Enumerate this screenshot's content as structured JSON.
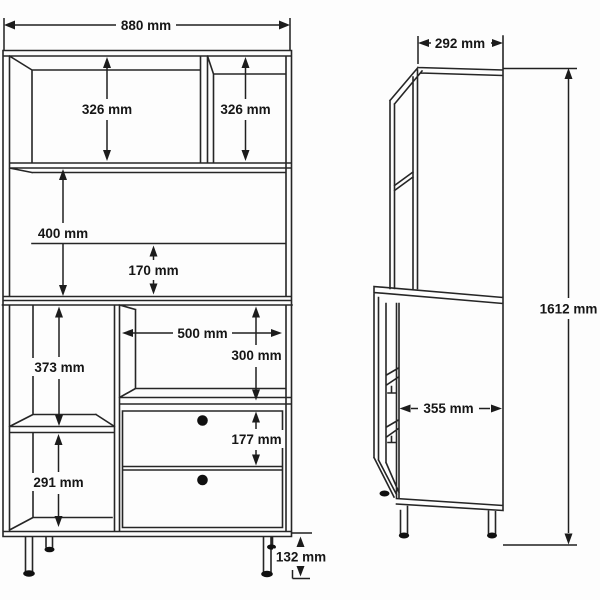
{
  "front_view": {
    "overall_width": "880 mm",
    "top_left_opening_height": "326 mm",
    "top_right_opening_height": "326 mm",
    "middle_opening_height": "400 mm",
    "back_gap_height": "170 mm",
    "lower_left_top_opening_height": "373 mm",
    "lower_left_bottom_opening_height": "291 mm",
    "niche_width": "500 mm",
    "niche_height": "300 mm",
    "drawer_height": "177 mm",
    "leg_height": "132 mm"
  },
  "side_view": {
    "top_depth": "292 mm",
    "bottom_depth": "355 mm",
    "total_height": "1612 mm"
  }
}
